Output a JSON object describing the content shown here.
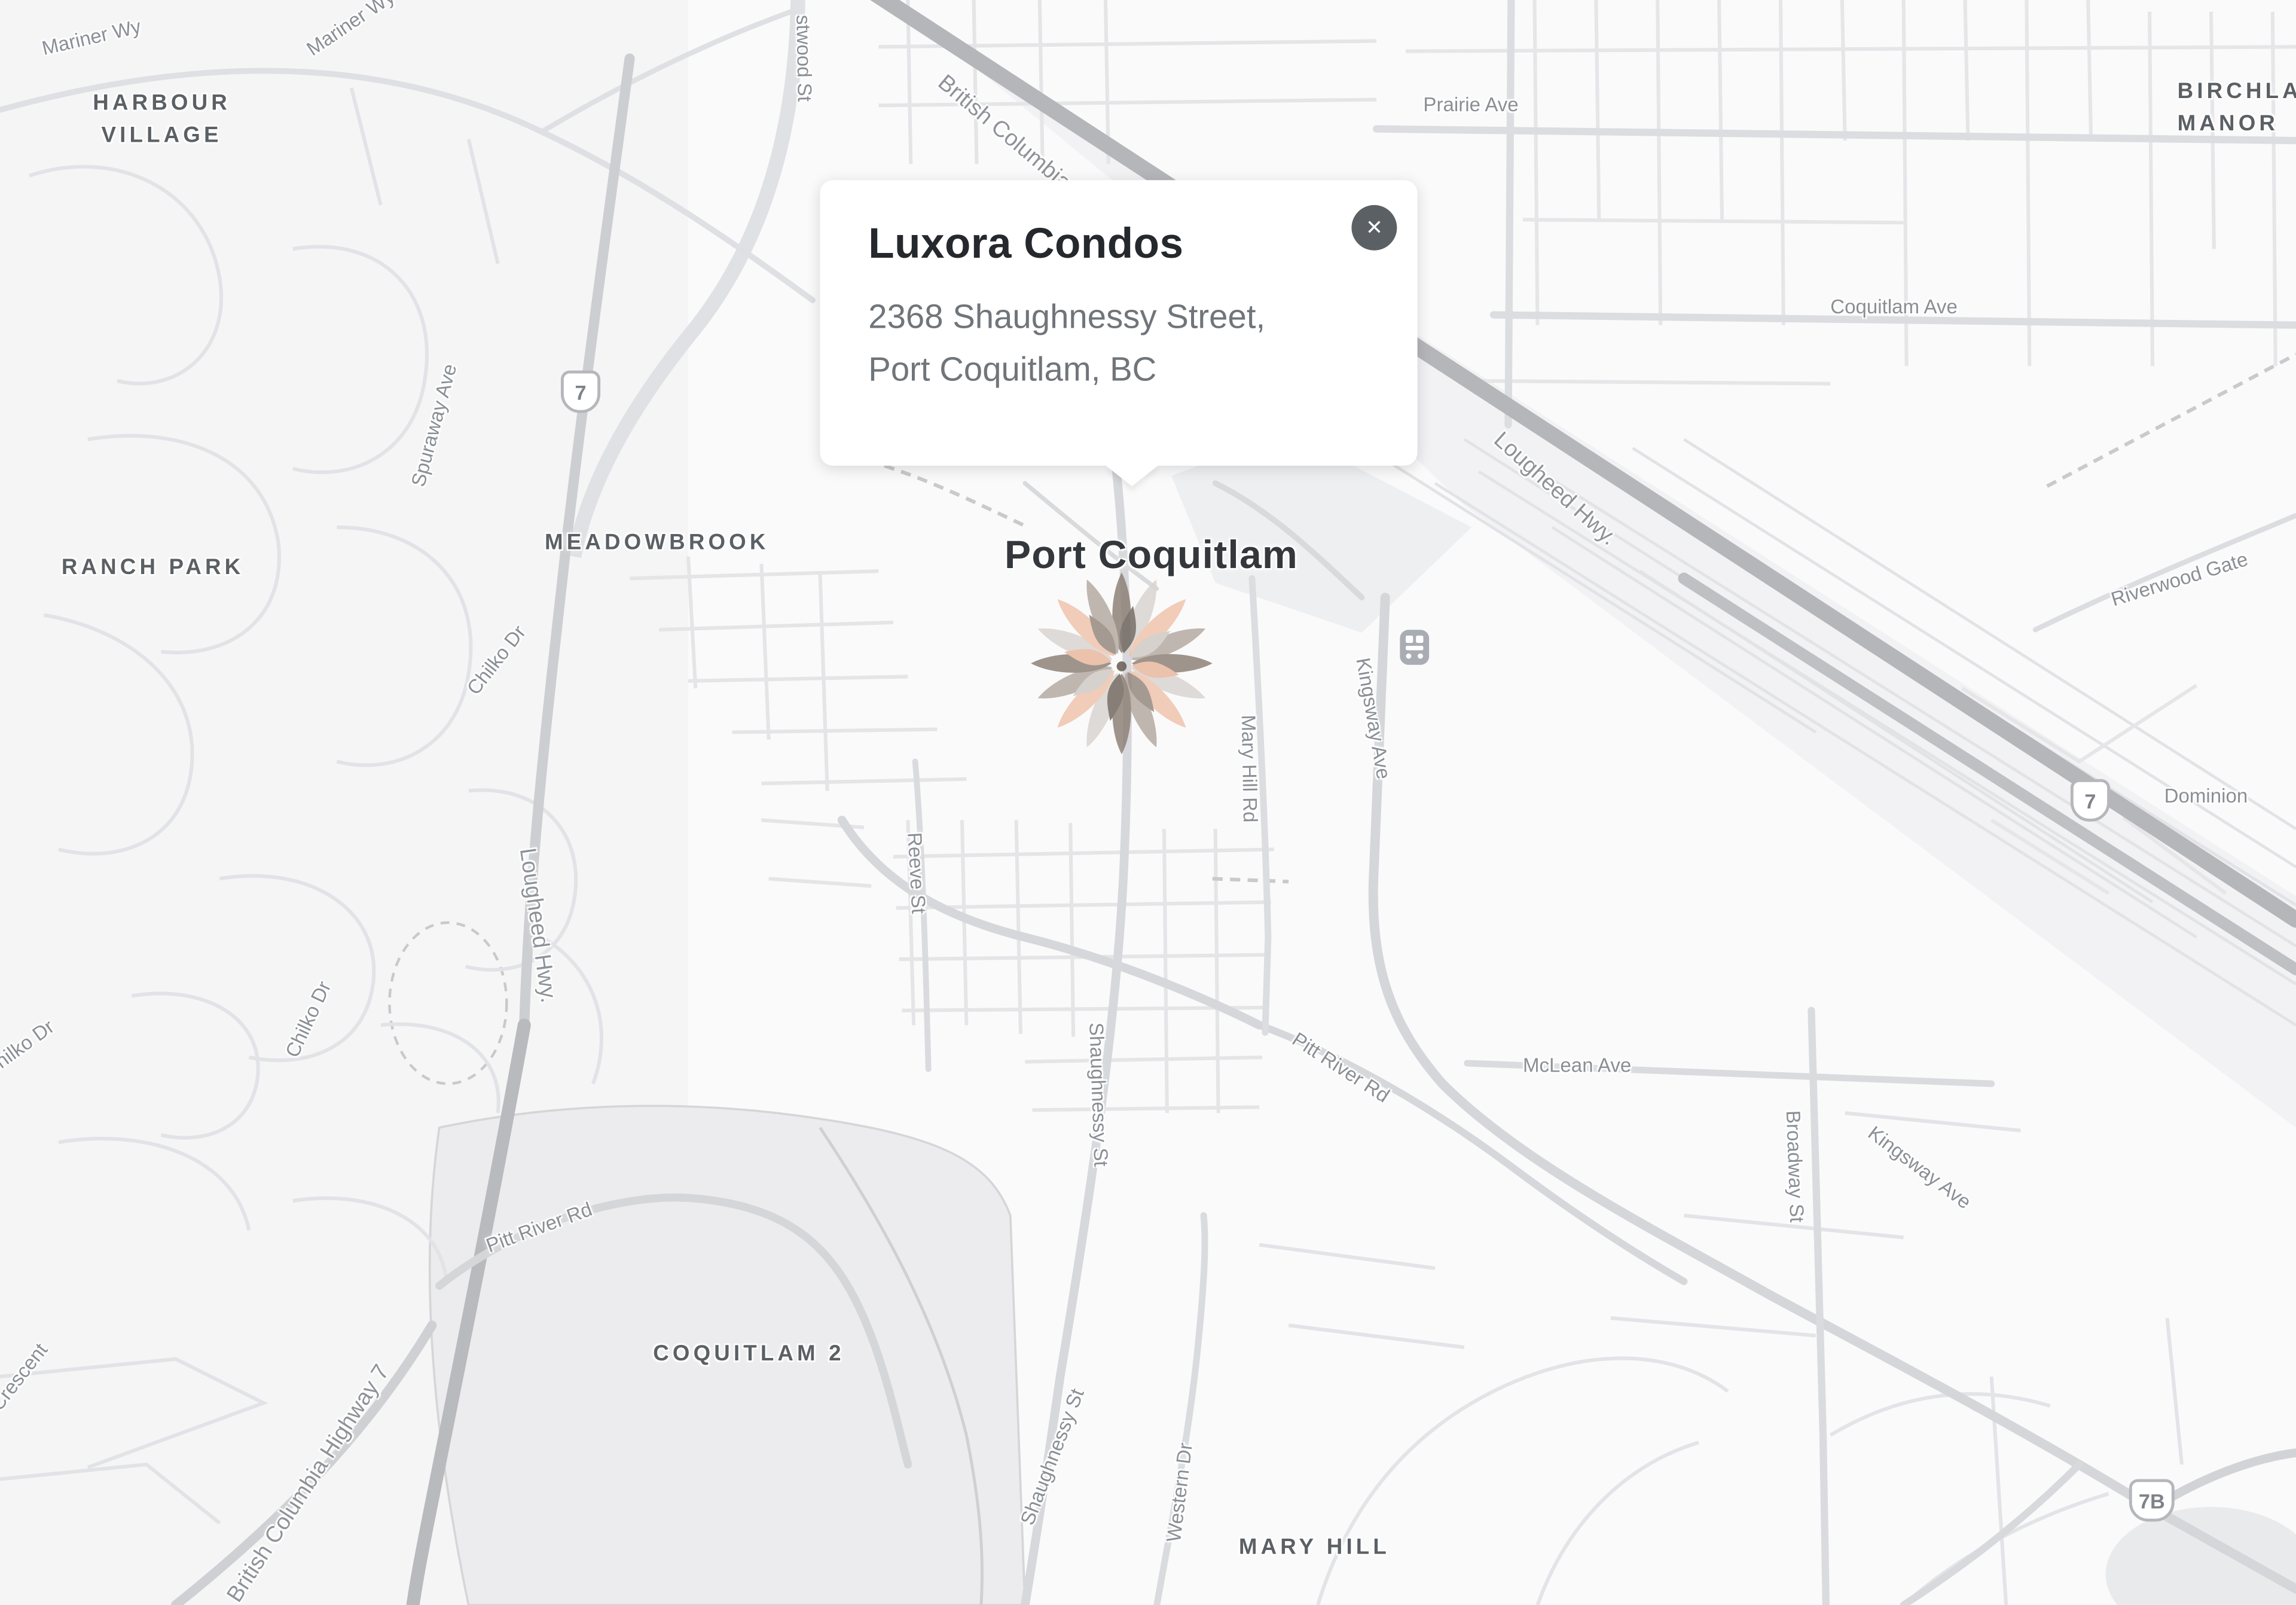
{
  "popup": {
    "title": "Luxora Condos",
    "address_line1": "2368 Shaughnessy Street,",
    "address_line2": "Port Coquitlam, BC",
    "close_glyph": "✕"
  },
  "shields": {
    "hwy7": "7",
    "hwy7b": "7B"
  },
  "map_labels": [
    {
      "text": "Mariner Wy"
    },
    {
      "text": "Mariner Wy"
    },
    {
      "text": "HARBOUR VILLAGE"
    },
    {
      "text": "stwood St"
    },
    {
      "text": "British Columbia"
    },
    {
      "text": "Prairie Ave"
    },
    {
      "text": "Coquitlam Ave"
    },
    {
      "text": "BIRCHLAND MANOR"
    },
    {
      "text": "Lougheed Hwy."
    },
    {
      "text": "Riverwood Gate"
    },
    {
      "text": "Spuraway Ave"
    },
    {
      "text": "RANCH PARK"
    },
    {
      "text": "MEADOWBROOK"
    },
    {
      "text": "Port Coquitlam"
    },
    {
      "text": "Chilko Dr"
    },
    {
      "text": "Chilko Dr"
    },
    {
      "text": "Chilko Dr"
    },
    {
      "text": "Lougheed Hwy."
    },
    {
      "text": "Kingsway Ave"
    },
    {
      "text": "Mary Hill Rd"
    },
    {
      "text": "Dominion"
    },
    {
      "text": "Reeve St"
    },
    {
      "text": "Shaughnessy St"
    },
    {
      "text": "Pitt River Rd"
    },
    {
      "text": "McLean Ave"
    },
    {
      "text": "Broadway St"
    },
    {
      "text": "Kingsway Ave"
    },
    {
      "text": "Pitt River Rd"
    },
    {
      "text": "COQUITLAM 2"
    },
    {
      "text": "British Columbia Highway 7"
    },
    {
      "text": "Riverview Crescent"
    },
    {
      "text": "Shaughnessy St"
    },
    {
      "text": "Western Dr"
    },
    {
      "text": "MARY HILL"
    }
  ],
  "marker": {
    "name": "brand-flower-marker",
    "petal_colors": [
      "#8b7e74",
      "#d8d4d0",
      "#eec3ab",
      "#b3a89f"
    ],
    "petal_colors_inner": [
      "#6e635b",
      "#cfc9c4",
      "#e8b69b",
      "#93867c"
    ]
  },
  "map_colors": {
    "background": "#fafafa",
    "road_minor": "#e4e5e8",
    "road_major": "#d6d7da",
    "highway_band": "#b5b6ba",
    "area_fill": "#ececee",
    "label_gray": "#8a8f95",
    "neighborhood_gray": "#5b6065"
  }
}
